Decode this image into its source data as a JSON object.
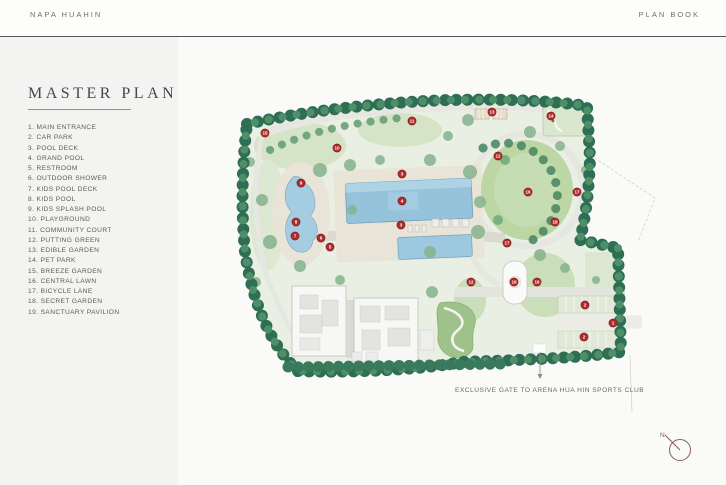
{
  "header": {
    "brand": "NAPA  HUAHIN",
    "page_label": "PLAN  BOOK"
  },
  "sidebar": {
    "title": "MASTER PLAN",
    "legend": [
      "1. MAIN ENTRANCE",
      "2. CAR PARK",
      "3. POOL DECK",
      "4. GRAND POOL",
      "5. RESTROOM",
      "6. OUTDOOR SHOWER",
      "7. KIDS POOL DECK",
      "8. KIDS POOL",
      "9. KIDS SPLASH POOL",
      "10. PLAYGROUND",
      "11. COMMUNITY COURT",
      "12. PUTTING GREEN",
      "13. EDIBLE GARDEN",
      "14. PET PARK",
      "15. BREEZE GARDEN",
      "16. CENTRAL LAWN",
      "17. BICYCLE LANE",
      "18. SECRET GARDEN",
      "19. SANCTUARY PAVILION"
    ]
  },
  "map": {
    "gate_note": "EXCLUSIVE GATE TO ARENA HUA HIN SPORTS CLUB",
    "compass_label": "N",
    "colors": {
      "tree_green": "#2e6e54",
      "lawn_green": "#c9dcb6",
      "pool_blue": "#96c3dc",
      "marker_red": "#b02c2c"
    },
    "markers": [
      {
        "n": "1"
      },
      {
        "n": "2"
      },
      {
        "n": "2"
      },
      {
        "n": "3"
      },
      {
        "n": "4"
      },
      {
        "n": "3"
      },
      {
        "n": "5"
      },
      {
        "n": "6"
      },
      {
        "n": "7"
      },
      {
        "n": "8"
      },
      {
        "n": "9"
      },
      {
        "n": "10"
      },
      {
        "n": "11"
      },
      {
        "n": "13"
      },
      {
        "n": "14"
      },
      {
        "n": "15"
      },
      {
        "n": "12"
      },
      {
        "n": "16"
      },
      {
        "n": "17"
      },
      {
        "n": "18"
      },
      {
        "n": "17"
      },
      {
        "n": "12"
      },
      {
        "n": "19"
      },
      {
        "n": "16"
      }
    ]
  }
}
